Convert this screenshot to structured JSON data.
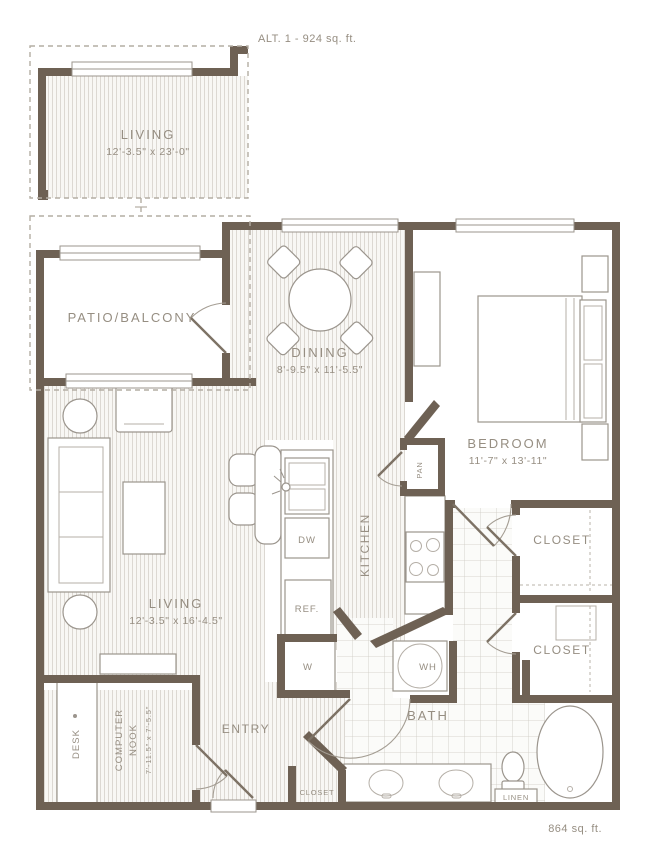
{
  "plan": {
    "alt": {
      "label": "ALT. 1 - 924 sq. ft.",
      "room": "LIVING",
      "dims": "12'-3.5\" x 23'-0\""
    },
    "patio": {
      "label": "PATIO/BALCONY"
    },
    "dining": {
      "label": "DINING",
      "dims": "8'-9.5\" x 11'-5.5\""
    },
    "bedroom": {
      "label": "BEDROOM",
      "dims": "11'-7\" x 13'-11\""
    },
    "living": {
      "label": "LIVING",
      "dims": "12'-3.5\" x 16'-4.5\""
    },
    "kitchen": {
      "label": "KITCHEN",
      "pantry": "PAN",
      "dishwasher": "DW",
      "refrigerator": "REF.",
      "washer": "W",
      "water_heater": "WH"
    },
    "closet1": {
      "label": "CLOSET"
    },
    "closet2": {
      "label": "CLOSET"
    },
    "nook": {
      "line1": "COMPUTER",
      "line2": "NOOK",
      "dims": "7'-11.5\" x 7'-5.5\"",
      "desk": "DESK"
    },
    "entry": {
      "label": "ENTRY",
      "closet": "CLOSET"
    },
    "bath": {
      "label": "BATH",
      "linen": "LINEN"
    },
    "total": "864 sq. ft.",
    "colors": {
      "wall": "#6e6154",
      "label_text": "#968e82",
      "stripe": "#dcd8d2",
      "tile": "#cdc9c2",
      "dashed_outline": "#b4ada3",
      "background": "#ffffff"
    }
  }
}
